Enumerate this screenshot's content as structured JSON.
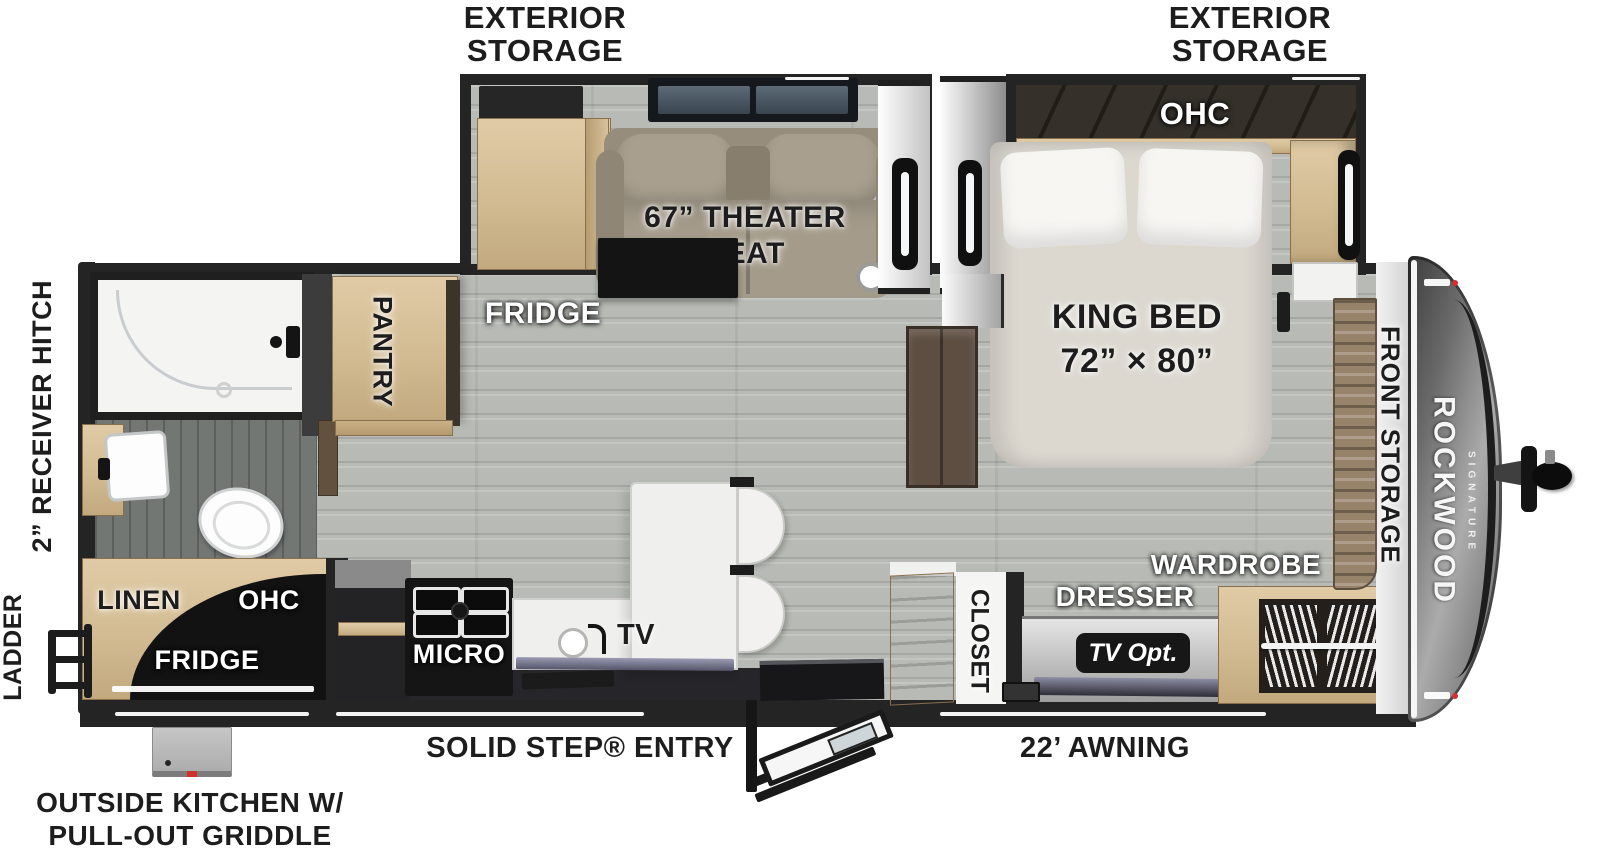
{
  "title": "Rockwood Signature travel trailer floor plan",
  "colors": {
    "wall": "#242424",
    "floor": "#b8bbb5",
    "floor_dark": "#737774",
    "wood": "#d2bb92",
    "wood_dark": "#8a6f4d",
    "seat": "#a49b8a",
    "mattress": "#dcd8d0",
    "counter": "#efefed",
    "appliance_black": "#161616",
    "cap_dark": "#474747",
    "cap_light": "#ababab",
    "badge": "#171717",
    "brown_door": "#5d4e41",
    "bins": "#97826a",
    "marker_red": "#d42f2f"
  },
  "labels": {
    "exterior_storage_line1": "EXTERIOR",
    "exterior_storage_line2": "STORAGE",
    "theater_seat_line1": "67” THEATER",
    "theater_seat_line2": "SEAT",
    "ohc_bedroom": "OHC",
    "king_bed_line1": "KING BED",
    "king_bed_line2": "72” × 80”",
    "fridge_main": "FRIDGE",
    "pantry": "PANTRY",
    "front_storage": "FRONT STORAGE",
    "brand": "ROCKWOOD",
    "brand_sub": "SIGNATURE",
    "receiver_hitch": "2” RECEIVER HITCH",
    "ladder": "LADDER",
    "linen": "LINEN",
    "ohc_outside": "OHC",
    "fridge_outside": "FRIDGE",
    "micro": "MICRO",
    "tv": "TV",
    "closet": "CLOSET",
    "dresser": "DRESSER",
    "wardrobe": "WARDROBE",
    "tv_opt": "TV Opt.",
    "solid_step_entry": "SOLID STEP® ENTRY",
    "awning": "22’ AWNING",
    "outside_kitchen_line1": "OUTSIDE KITCHEN W/",
    "outside_kitchen_line2": "PULL-OUT GRIDDLE"
  }
}
